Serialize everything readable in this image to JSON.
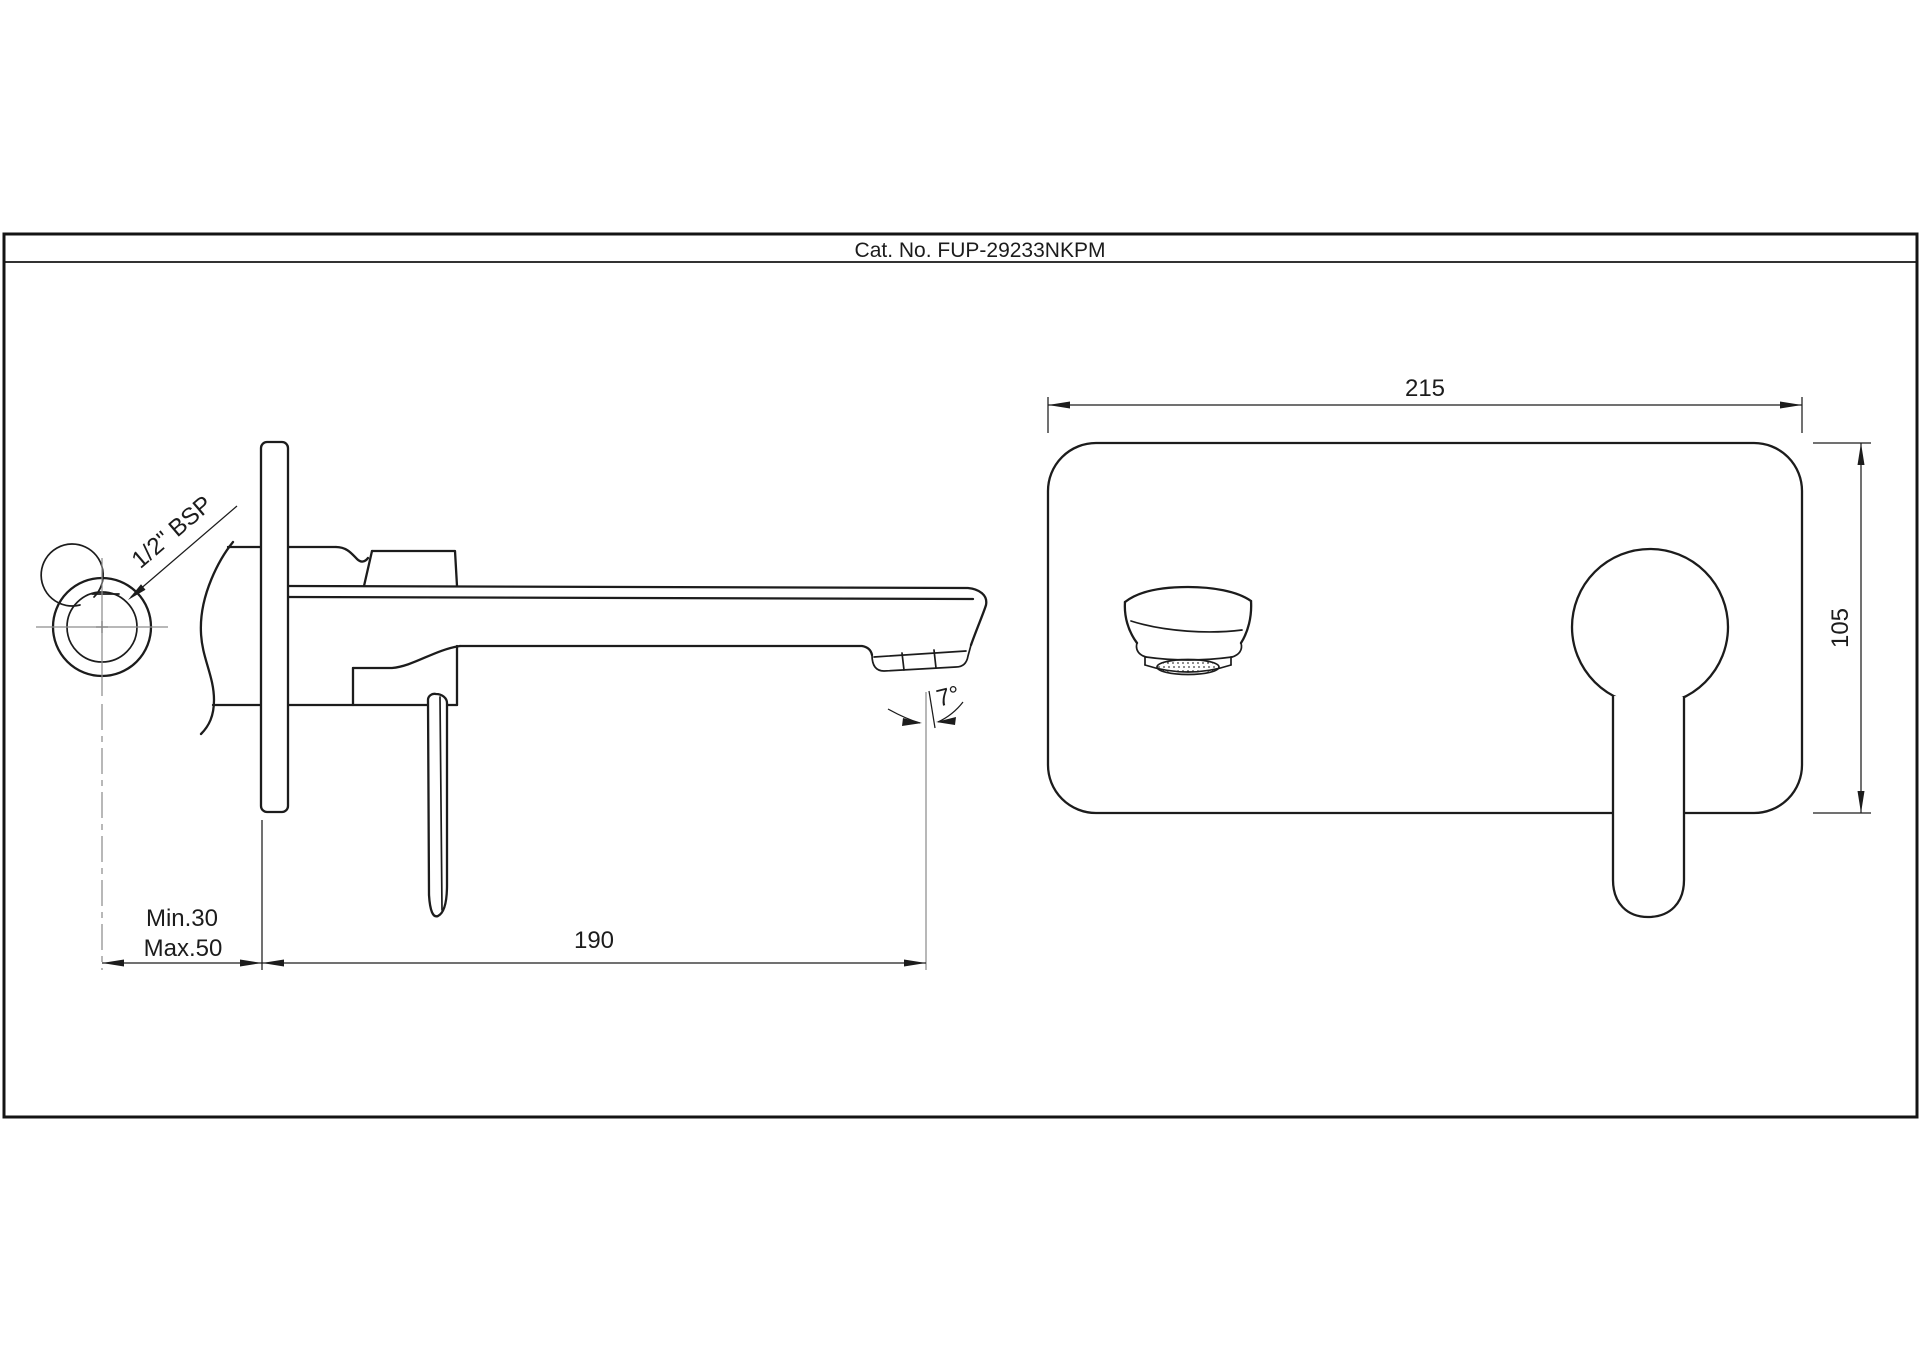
{
  "title_block": {
    "catalog_label": "Cat. No. FUP-29233NKPM"
  },
  "colors": {
    "line": "#1c1c1c",
    "centerline": "#8d8d8d",
    "background": "#ffffff"
  },
  "side_view": {
    "name": "side-elevation-wall-mounted-basin-mixer",
    "labels": {
      "thread": "1/2\" BSP",
      "depth_min": "Min.30",
      "depth_max": "Max.50",
      "reach": "190",
      "angle": "7°"
    }
  },
  "front_view": {
    "name": "front-elevation-faceplate",
    "labels": {
      "width": "215",
      "height": "105"
    }
  }
}
